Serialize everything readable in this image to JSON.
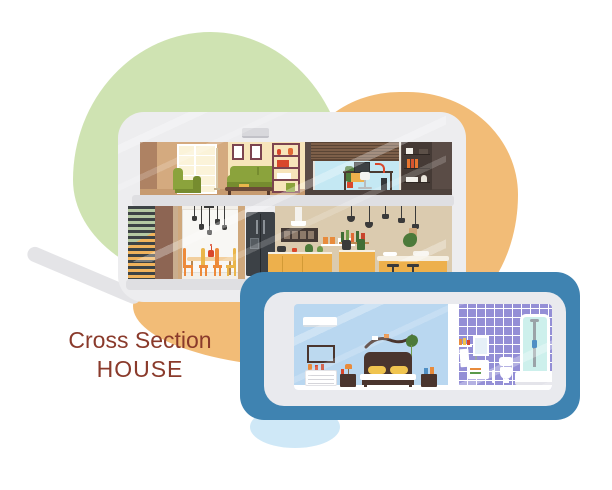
{
  "title": {
    "line1": "Cross Section",
    "line2": "HOUSE"
  },
  "colors": {
    "blob-green": "#cfe3b2",
    "blob-orange": "#f2bc77",
    "blob-lightblue": "#cfe8f7",
    "swoosh-gray": "#e4e4e7",
    "house-frame": "#ededef",
    "slab-gray": "#dfdfe2",
    "living-wall": "#d4aa7f",
    "living-wall-dark": "#ae8263",
    "living-wall-light": "#f7e5ba",
    "window-pane": "#fbf3d9",
    "floor-tan": "#c79b70",
    "sofa-green": "#8ba33c",
    "sofa-green-dark": "#768c2f",
    "maroon": "#7c4450",
    "office-wall": "#5a4c46",
    "office-floor": "#4e423c",
    "sky-blue": "#c4e8f3",
    "blinds-brown": "#7d5f49",
    "bookcase-brown": "#453a35",
    "stair-dark": "#3d4345",
    "stair-green": "#b5c9a2",
    "stair-orange": "#f0b35c",
    "stair-wall-brown": "#8d6553",
    "dining-wall": "#f2efe9",
    "dining-window": "#f8f7f4",
    "tan-column": "#cfa87c",
    "chair-orange": "#ed8a3a",
    "chair-amber": "#eab64b",
    "wood-light": "#f2cf9e",
    "fridge-dark": "#3c4146",
    "kitchen-wall": "#dbcbaf",
    "counter-yellow": "#edb04c",
    "counter-top": "#f5efe2",
    "accent-red": "#d9472b",
    "accent-green": "#4c7a3a",
    "lamp-dark": "#3a3a3a",
    "tablet-blue": "#3f83b1",
    "tablet-frame": "#e9eaee",
    "bedroom-wall": "#b9d7f0",
    "bed-brown": "#4a352e",
    "pillow-yellow": "#f0c44f",
    "tile-purple": "#948fd6",
    "shower-glass": "#cdf0ec",
    "metal-gray": "#9aa3a8",
    "floor-gray": "#d9d6d0",
    "screen-blue": "#bcd9ef",
    "title-brown": "#8a3a2b",
    "white": "#ffffff"
  },
  "scene": {
    "background_shapes": [
      "green-blob",
      "orange-blob",
      "light-blue-blob",
      "gray-swoosh"
    ],
    "house": {
      "floors": [
        {
          "name": "top-floor",
          "rooms": [
            {
              "name": "living-room",
              "furniture": [
                "window",
                "floor-lamp",
                "armchair",
                "sofa",
                "coffee-table",
                "wall-pictures",
                "air-conditioner",
                "shelving-unit"
              ]
            },
            {
              "name": "home-office",
              "furniture": [
                "window-with-blinds",
                "desk",
                "computer-monitor",
                "desk-lamp",
                "office-chair",
                "pc-tower",
                "bookcase",
                "potted-plant"
              ]
            }
          ]
        },
        {
          "name": "ground-floor",
          "rooms": [
            {
              "name": "staircase",
              "furniture": [
                "steps"
              ]
            },
            {
              "name": "dining-room",
              "furniture": [
                "pendant-lights",
                "dining-table",
                "vase",
                "chairs"
              ]
            },
            {
              "name": "kitchen",
              "furniture": [
                "fridge",
                "range-hood",
                "wall-shelf",
                "canisters",
                "bottle-shelf",
                "pendant-lights",
                "counter",
                "coffee-maker",
                "juicer",
                "bar-counter",
                "bar-stools",
                "hanging-plant"
              ]
            }
          ]
        }
      ]
    },
    "tablet": {
      "rooms": [
        {
          "name": "bedroom",
          "furniture": [
            "air-conditioner",
            "tv",
            "dresser",
            "nightstand-left",
            "nightstand-right",
            "table-lamp",
            "bed",
            "pillows",
            "curved-shelf",
            "hanging-plant"
          ]
        },
        {
          "name": "bathroom",
          "furniture": [
            "tiled-wall",
            "toiletry-shelf",
            "towel",
            "mirror",
            "vanity-sink",
            "toilet",
            "toilet-brush",
            "shower-cabin"
          ]
        }
      ]
    }
  }
}
